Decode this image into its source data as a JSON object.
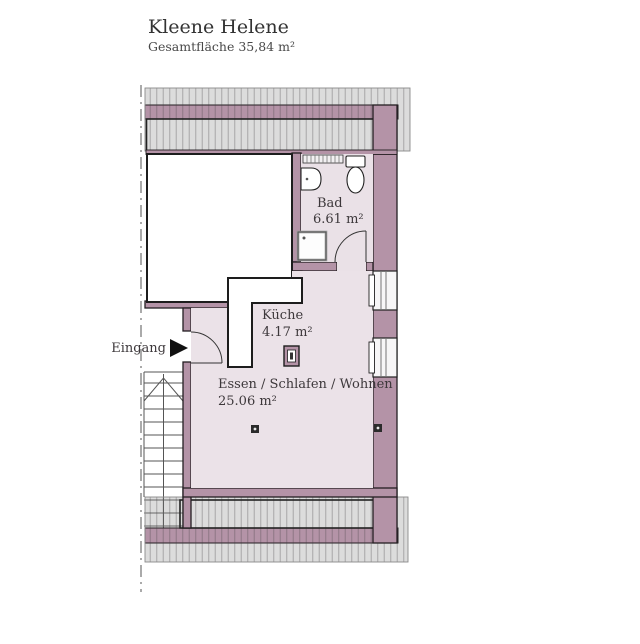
{
  "header": {
    "title": "Kleene Helene",
    "subtitle": "Gesamtfläche 35,84 m²"
  },
  "rooms": {
    "bad": {
      "name": "Bad",
      "area": "6.61 m²"
    },
    "kueche": {
      "name": "Küche",
      "area": "4.17 m²"
    },
    "wohnen": {
      "name": "Essen / Schlafen / Wohnen",
      "area": "25.06 m²"
    }
  },
  "entrance": {
    "label": "Eingang"
  },
  "colors": {
    "wall": "#b493a7",
    "wall_edge": "#241e22",
    "floor": "#ebe2e8",
    "floor_bad": "#eae1e7",
    "hatch_bg": "#dcdcdc",
    "hatch_line": "#5a5560",
    "outline": "#1d1d1d",
    "text": "#3a3a3a",
    "stair_line": "#555555"
  }
}
